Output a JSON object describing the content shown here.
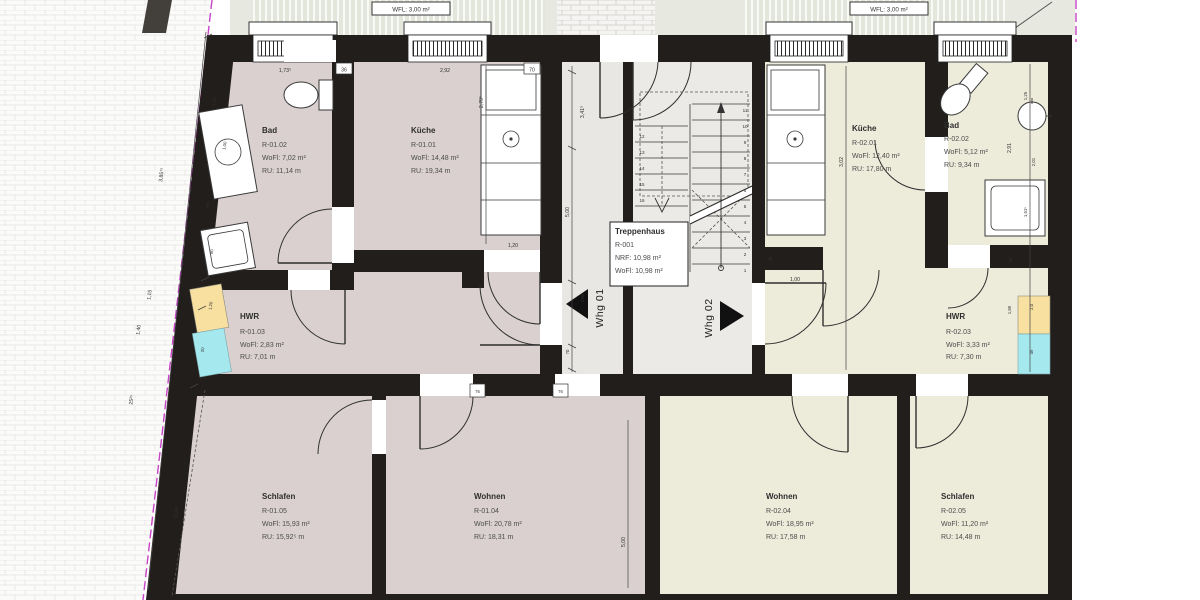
{
  "plan_title": "Erdgeschoss Wohnungen Whg 01 / Whg 02",
  "colors": {
    "wall": "#211e1b",
    "floor_left_apartment": "#d9d0cf",
    "floor_right_apartment": "#edecdb",
    "floor_hall": "#e9e7e3",
    "balcony": "#e3e6db",
    "insulation_yellow": "#f7e0a0",
    "insulation_cyan": "#a5e9ef",
    "property_line_magenta": "#c743c7"
  },
  "balconies": {
    "left_label": "WFL: 3,00 m²",
    "right_label": "WFL: 3,00 m²"
  },
  "apartments": {
    "whg1_label": "Whg 01",
    "whg2_label": "Whg 02"
  },
  "rooms": {
    "bad1": {
      "name": "Bad",
      "nr": "R-01.02",
      "wofl": "WoFl: 7,02 m²",
      "ru": "RU:   11,14 m"
    },
    "kueche1": {
      "name": "Küche",
      "nr": "R-01.01",
      "wofl": "WoFl: 14,48 m²",
      "ru": "RU:   19,34 m"
    },
    "hwr1": {
      "name": "HWR",
      "nr": "R-01.03",
      "wofl": "WoFl: 2,83 m²",
      "ru": "RU:   7,01 m"
    },
    "schlafen1": {
      "name": "Schlafen",
      "nr": "R-01.05",
      "wofl": "WoFl: 15,93 m²",
      "ru": "RU:   15,92⁵ m"
    },
    "wohnen1": {
      "name": "Wohnen",
      "nr": "R-01.04",
      "wofl": "WoFl: 20,78 m²",
      "ru": "RU:   18,31 m"
    },
    "treppenhaus": {
      "name": "Treppenhaus",
      "nr": "R-001",
      "nrf": "NRF:  10,98 m²",
      "wofl": "WoFl: 10,98 m²"
    },
    "kueche2": {
      "name": "Küche",
      "nr": "R-02.01",
      "wofl": "WoFl: 12,40 m²",
      "ru": "RU:   17,80 m"
    },
    "bad2": {
      "name": "Bad",
      "nr": "R-02.02",
      "wofl": "WoFl: 5,12 m²",
      "ru": "RU:   9,34 m"
    },
    "hwr2": {
      "name": "HWR",
      "nr": "R-02.03",
      "wofl": "WoFl: 3,33 m²",
      "ru": "RU:   7,30 m"
    },
    "wohnen2": {
      "name": "Wohnen",
      "nr": "R-02.04",
      "wofl": "WoFl: 18,95 m²",
      "ru": "RU:   17,58 m"
    },
    "schlafen2": {
      "name": "Schlafen",
      "nr": "R-02.05",
      "wofl": "WoFl: 11,20 m²",
      "ru": "RU:   14,48 m"
    }
  },
  "dims": {
    "left1": "3,85⁷⁵",
    "left2": "1,15",
    "left3": "1,40",
    "left4": "25²⁵",
    "left5": "4,04⁴",
    "top1": "1,73⁵",
    "top2": "36",
    "top3": "2,92",
    "top4": "70",
    "k1v": "2,79⁵",
    "k1b": "1,20",
    "hall_v": "5,00",
    "hall_top": "3,41⁵",
    "hall_70": "70",
    "hall_201": "2,01",
    "k2b": "1,00",
    "k2v": "3,02",
    "k2s": "40",
    "b2v": "2,91",
    "b2a": "1,25",
    "b2b": "2,01",
    "b2c": "1,61⁵",
    "b2d": "20",
    "h2a": "1,89",
    "h2b": "2,0",
    "h2c": "49",
    "h1a": "1,20",
    "h1b": "20",
    "w1v": "5,00",
    "lint1": "76",
    "lint2": "76",
    "b1a": "1,01¹⁵",
    "b1b": "60",
    "b1c": "90",
    "b1d": "1,00"
  },
  "stairs": {
    "right": [
      "1",
      "2",
      "3",
      "4",
      "5",
      "6",
      "7",
      "8",
      "9",
      "10",
      "11"
    ],
    "left": [
      "12",
      "13",
      "14",
      "15",
      "16"
    ]
  }
}
